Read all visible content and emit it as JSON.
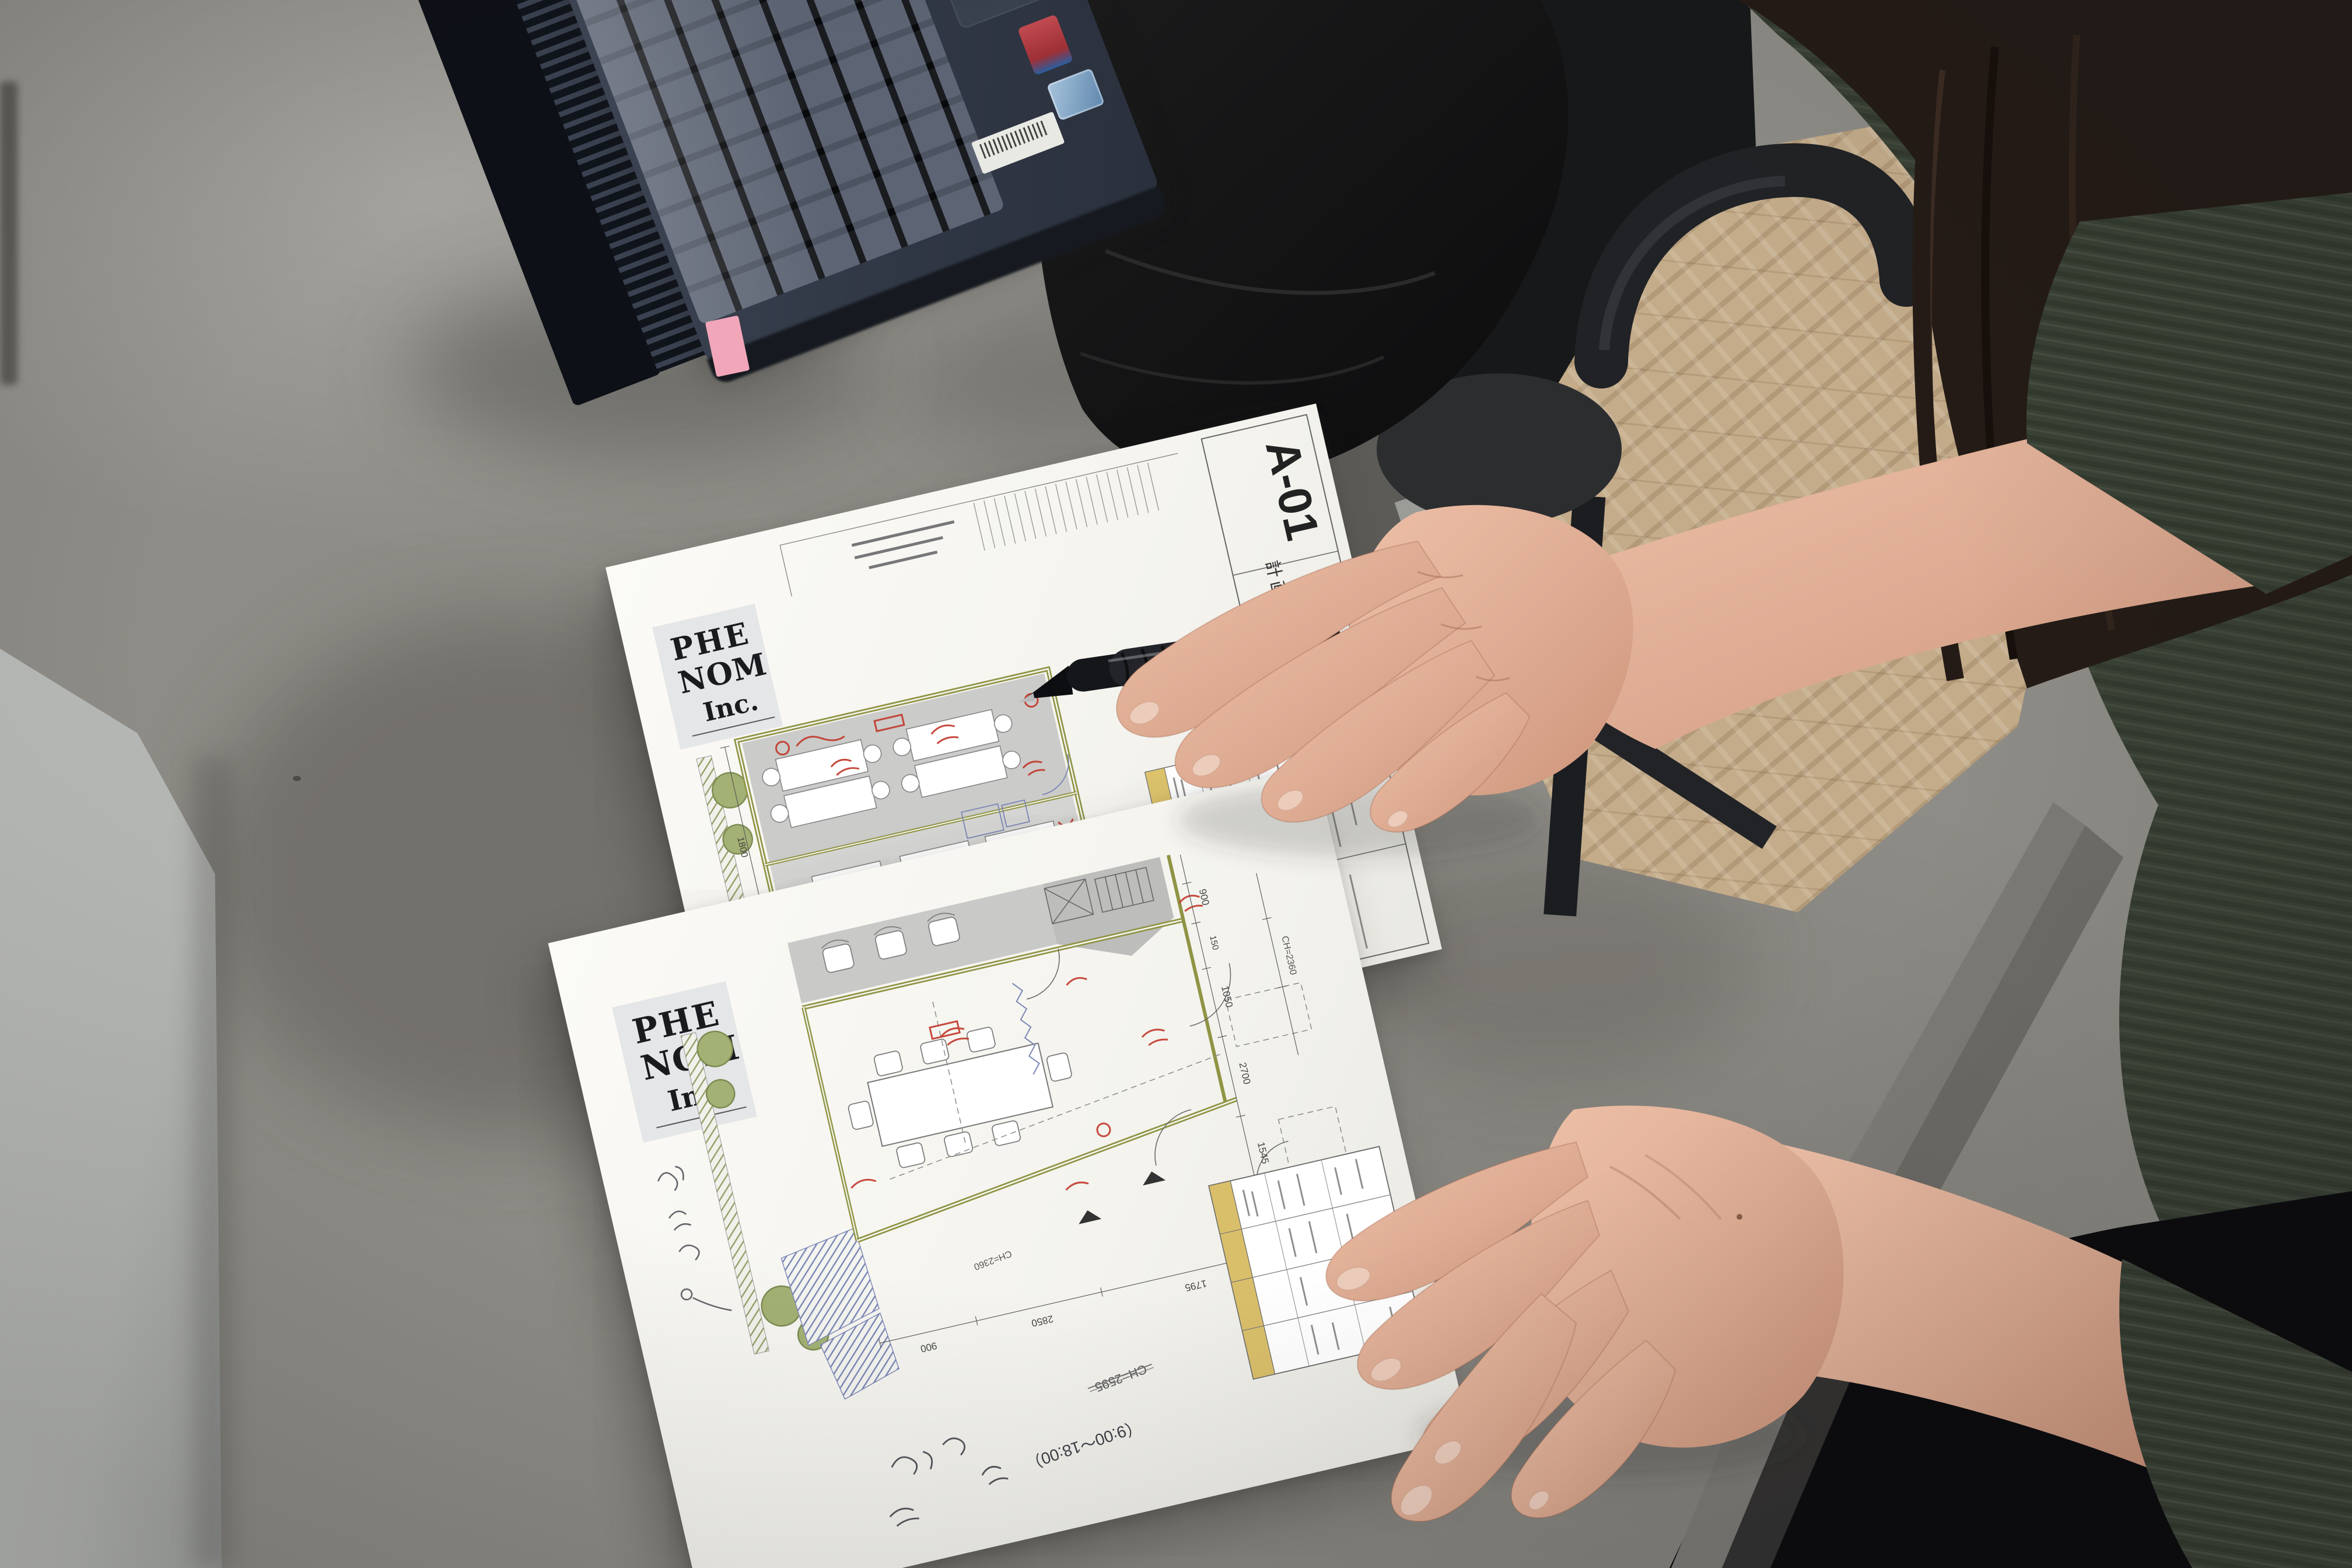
{
  "scene": {
    "description": "Photo taken from above of a gray concrete desk. Two printed architectural floor plans lie on the desk; a person in a dark green knit sweater with long dark hair points a black click pen at the upper drawing with their right hand while their left hand rests on the lower drawing. A dark navy laptop with Japanese keyboard sits at top left; a black office chair, black trousers of a second seated person and herringbone wood flooring are visible at top right.",
    "colors": {
      "desk_top": "#aaa8a3",
      "desk_shadow": "#8e8c86",
      "side_panel": "#b7b9b6",
      "wood_floor": "#c4ac8a",
      "laptop_body": "#2e3542",
      "laptop_keys": "#4d5565",
      "sticker_red": "#b2383f",
      "sticker_blue": "#7aa7c9",
      "sticky_tab_pink": "#f2a6ba",
      "paper": "#f8f7f3",
      "plan_floor_gray": "#c9c9c7",
      "plan_wall_olive": "#8f9444",
      "plan_tree_green": "#a3b174",
      "plan_hatch_blue": "#7b86b5",
      "annotation_red": "#c23b2e",
      "table_band_yellow": "#dcc36c",
      "skin": "#ddab92",
      "sweater_green": "#3a4135",
      "hair_brown": "#241b16",
      "clothing_black": "#101012",
      "pen_black": "#15161a"
    }
  },
  "laptop": {
    "kind": "dark navy laptop, Japanese keyboard",
    "stickers": [
      "red processor sticker",
      "blue OS sticker",
      "white barcode label"
    ],
    "sticky_tab": "pink page marker"
  },
  "pen": {
    "body": "black click ballpoint",
    "ring": "white accent ring"
  },
  "sheets": {
    "sheet1": {
      "logo": {
        "l1": "PHE",
        "l2": "NOM",
        "l3": "Inc."
      },
      "drawing_number": "A-01",
      "title_block_label": "計画平面図",
      "dims": [
        "2700",
        "900",
        "1225",
        "1800"
      ],
      "legend_colors": [
        "#b9d36a",
        "#c98a4f"
      ]
    },
    "sheet2": {
      "logo": {
        "l1": "PHE",
        "l2": "NOM",
        "l3": "Inc."
      },
      "note_time": "（9:00〜18:00）",
      "ch_labels": [
        "CH=2595",
        "CH=2360"
      ],
      "dims": [
        "900",
        "150",
        "1050",
        "2700",
        "1545",
        "2850",
        "1795",
        "300"
      ]
    }
  }
}
